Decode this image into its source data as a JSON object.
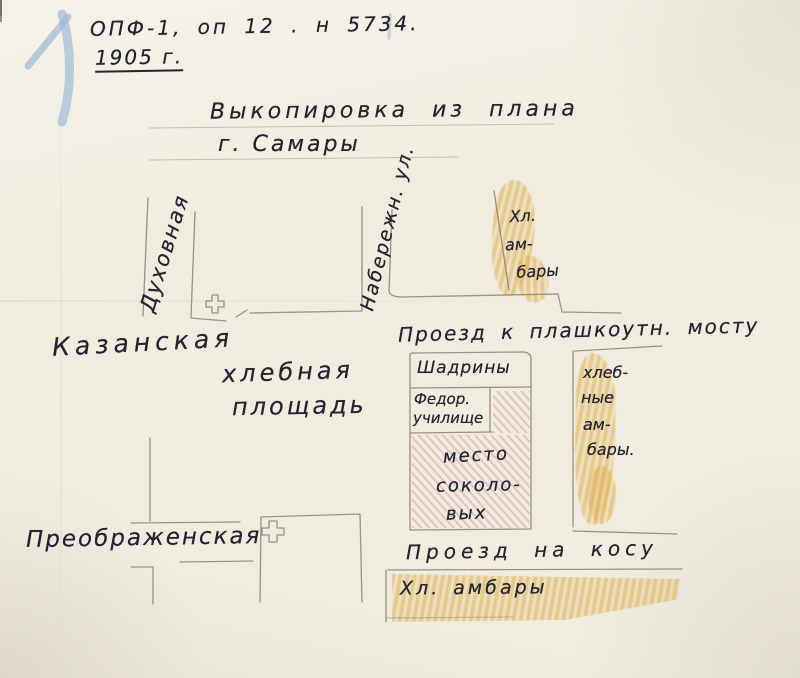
{
  "document": {
    "archive_ref": "ОПФ-1, оп 12 . н 5734.",
    "year": "1905 г.",
    "title_line1": "Выкопировка из плана",
    "title_line2": "г. Самары"
  },
  "streets": {
    "dukhovnaya": "Духовная",
    "naberezhnaya": "Набережн. ул.",
    "kazanskaya": "Казанская",
    "khlebnaya_line1": "хлебная",
    "khlebnaya_line2": "площадь",
    "proezd_most": "Проезд к плашкоутн. мосту",
    "preobrazhenskaya": "Преображенская",
    "proezd_kosa": "Проезд на косу"
  },
  "blocks": {
    "top_barns": [
      "Хл.",
      "ам-",
      "бары"
    ],
    "shadrin_label": "Шадрины",
    "school_line1": "Федор.",
    "school_line2": "училище",
    "sokolov": [
      "место",
      "соколо-",
      "вых"
    ],
    "right_barns": [
      "хлеб-",
      "ные",
      "ам-",
      "бары."
    ],
    "bottom_barns": "Хл. амбары"
  },
  "colors": {
    "paper": "#f0ecdf",
    "ink": "#24242f",
    "pencil": "#8a8375",
    "orange": "#e0ae45",
    "pink": "#d9848f",
    "blue": "#9bb9d2"
  }
}
